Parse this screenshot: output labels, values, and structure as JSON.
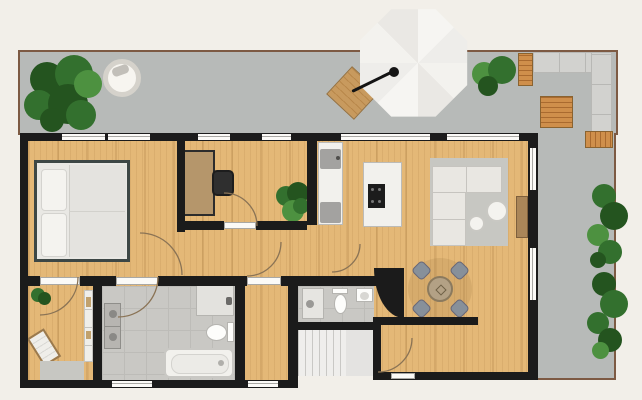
{
  "scene": {
    "type": "floor-plan",
    "description": "Top-view 2D apartment floor plan with wrap-around terrace, no text labels"
  },
  "palette": {
    "bg": "#f2efe9",
    "terrace": "#b7bab8",
    "terrace_border": "#7d5a43",
    "wall": "#1b1b1b",
    "wood": "#e4b877",
    "tile": "#c9c8c4",
    "tile_line": "#bdbcb8",
    "fixture": "#f2f1ed",
    "fixture_border": "#bcbbb7",
    "appliance": "#a3a2a0",
    "sofa": "#e9e7e2",
    "sofa_border": "#c6c4bf",
    "rug": "#c7c7c2",
    "plant": "#33702e",
    "plant_dark": "#24541f",
    "plant_light": "#4d9140",
    "outdoor_wood": "#cf8f4b",
    "outdoor_wood_dark": "#a96a2f",
    "stairs": "#efeeec",
    "stair_line": "#c9c8c5",
    "door_arc": "#8a7355",
    "desk": "#b5966b",
    "bedframe": "#3d4745",
    "chair_dark": "#2f2f2f",
    "dining_chair": "#87909a",
    "dining_table": "#b3a185",
    "win": "#fbfaf7",
    "win_line": "#a9a8a4"
  },
  "rooms": [
    {
      "name": "terrace",
      "floor": "concrete-gray",
      "furniture": [
        "potted-plant",
        "round-table",
        "cantilever-umbrella",
        "wooden-side-table",
        "bushes",
        "outdoor-corner-sofa",
        "wooden-coffee-table",
        "wooden-bench-tables",
        "hedge-plants"
      ]
    },
    {
      "name": "bedroom",
      "floor": "wood",
      "furniture": [
        "double-bed"
      ]
    },
    {
      "name": "office",
      "floor": "wood",
      "furniture": [
        "desk",
        "office-chair",
        "potted-plant"
      ]
    },
    {
      "name": "kitchen",
      "floor": "wood",
      "furniture": [
        "counter-with-sink",
        "island-with-cooktop"
      ]
    },
    {
      "name": "living-dining-room",
      "floor": "wood",
      "furniture": [
        "corner-sofa",
        "rug",
        "round-coffee-tables",
        "sideboard",
        "dining-table",
        "dining-chairs"
      ]
    },
    {
      "name": "corridor",
      "floor": "wood",
      "furniture": []
    },
    {
      "name": "walk-in-room",
      "floor": "wood",
      "furniture": [
        "lounge-chair",
        "potted-plant",
        "shelf",
        "rug"
      ]
    },
    {
      "name": "bathroom",
      "floor": "tile",
      "furniture": [
        "washer-dryer-stack",
        "vanity-sink",
        "toilet",
        "bathtub"
      ]
    },
    {
      "name": "storage-room",
      "floor": "wood",
      "furniture": []
    },
    {
      "name": "guest-wc",
      "floor": "tile",
      "furniture": [
        "washing-machine",
        "toilet",
        "wall-sink"
      ]
    },
    {
      "name": "entrance-hall",
      "floor": "wood",
      "furniture": []
    },
    {
      "name": "staircase",
      "floor": "stairs",
      "furniture": [
        "exterior-stairs"
      ]
    }
  ]
}
